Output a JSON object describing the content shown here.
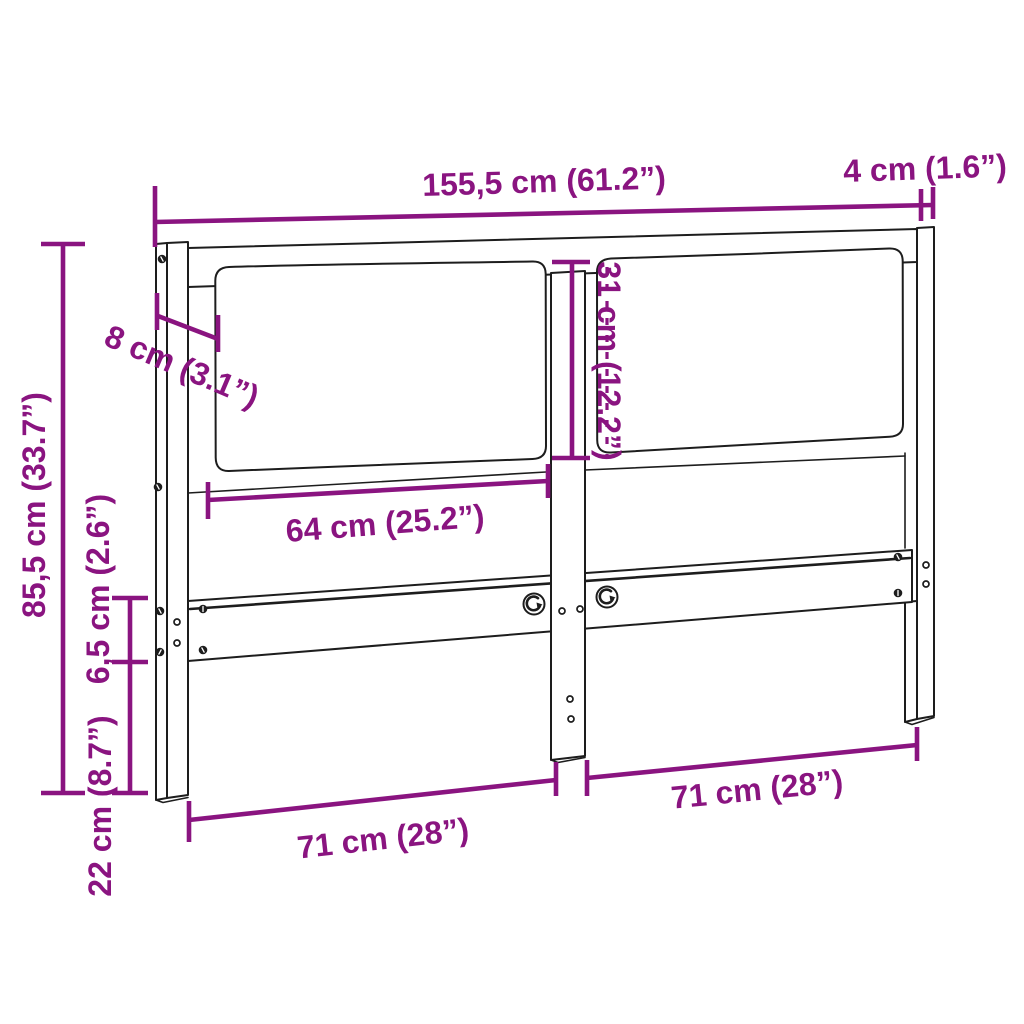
{
  "diagram": {
    "type": "furniture-dimension-diagram",
    "subject": "headboard with two upholstered cushion panels, three posts and a lower mounting rail",
    "accent_color": "#8A1480",
    "line_color": "#1d1d1d",
    "background_color": "#ffffff",
    "dims": {
      "overall_width": {
        "label": "155,5 cm (61.2”)",
        "cm": "155,5",
        "in": "61.2"
      },
      "side_post_depth": {
        "label": "4 cm (1.6”)",
        "cm": "4",
        "in": "1.6"
      },
      "side_post_width": {
        "label": "8 cm (3.1”)",
        "cm": "8",
        "in": "3.1"
      },
      "cushion_height": {
        "label": "31 cm (12.2”)",
        "cm": "31",
        "in": "12.2"
      },
      "cushion_width": {
        "label": "64 cm (25.2”)",
        "cm": "64",
        "in": "25.2"
      },
      "overall_height": {
        "label": "85,5 cm (33.7”)",
        "cm": "85,5",
        "in": "33.7"
      },
      "rail_height": {
        "label": "6,5 cm (2.6”)",
        "cm": "6,5",
        "in": "2.6"
      },
      "bottom_clearance": {
        "label": "22 cm (8.7”)",
        "cm": "22",
        "in": "8.7"
      },
      "left_section_width": {
        "label": "71 cm (28”)",
        "cm": "71",
        "in": "28"
      },
      "right_section_width": {
        "label": "71 cm (28”)",
        "cm": "71",
        "in": "28"
      }
    }
  }
}
